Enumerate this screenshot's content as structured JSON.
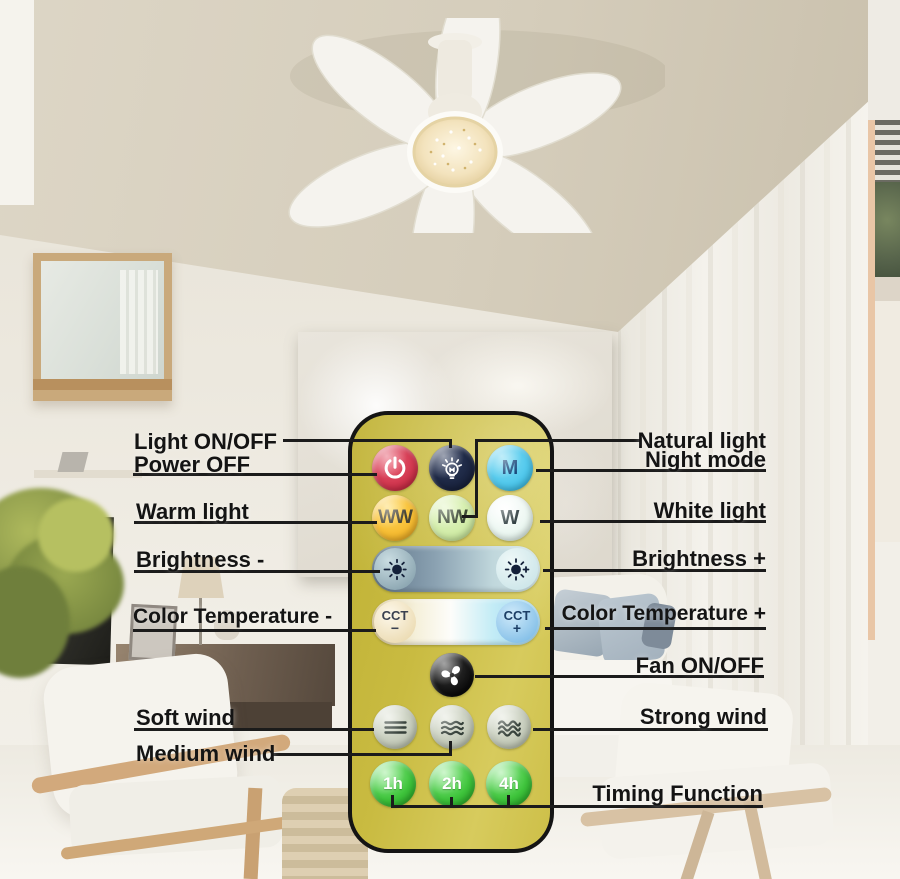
{
  "callouts": {
    "left": [
      {
        "id": "light-on-off",
        "text": "Light ON/OFF"
      },
      {
        "id": "power-off",
        "text": "Power OFF"
      },
      {
        "id": "warm-light",
        "text": "Warm light"
      },
      {
        "id": "brightness-minus",
        "text": "Brightness -"
      },
      {
        "id": "color-temperature-minus",
        "text": "Color Temperature -"
      },
      {
        "id": "soft-wind",
        "text": "Soft wind"
      },
      {
        "id": "medium-wind",
        "text": "Medium wind"
      }
    ],
    "right": [
      {
        "id": "natural-light",
        "text": "Natural light"
      },
      {
        "id": "night-mode",
        "text": "Night mode"
      },
      {
        "id": "white-light",
        "text": "White light"
      },
      {
        "id": "brightness-plus",
        "text": "Brightness +"
      },
      {
        "id": "color-temperature-plus",
        "text": "Color Temperature +"
      },
      {
        "id": "fan-on-off",
        "text": "Fan ON/OFF"
      },
      {
        "id": "strong-wind",
        "text": "Strong wind"
      },
      {
        "id": "timing-function",
        "text": "Timing Function"
      }
    ]
  },
  "remote": {
    "buttons": {
      "power": {
        "icon": "power-icon"
      },
      "light": {
        "icon": "bulb-icon"
      },
      "mode": {
        "label": "M"
      },
      "warm_white": {
        "label": "WW"
      },
      "natural_white": {
        "label": "NW"
      },
      "white": {
        "label": "W"
      },
      "brightness_down": {
        "icon": "sun-dim-icon"
      },
      "brightness_up": {
        "icon": "sun-bright-icon"
      },
      "cct_minus": {
        "label": "CCT",
        "sign": "−"
      },
      "cct_plus": {
        "label": "CCT",
        "sign": "+"
      },
      "fan_power": {
        "icon": "fan-icon"
      },
      "wind_soft": {
        "icon": "wind-soft-icon"
      },
      "wind_medium": {
        "icon": "wind-medium-icon"
      },
      "wind_strong": {
        "icon": "wind-strong-icon"
      },
      "timer_1h": {
        "label": "1h"
      },
      "timer_2h": {
        "label": "2h"
      },
      "timer_4h": {
        "label": "4h"
      }
    },
    "colors": {
      "body": "#c9bb41",
      "power_button": "#cc2e47",
      "light_button": "#17203a",
      "mode_button": "#45c3ea",
      "warm_white_button": "#f5b92e",
      "natural_white_button": "#cdeaa2",
      "white_button": "#e7f5ee",
      "cct_plus_button": "#85c0e8",
      "timer_button": "#3fc43c"
    }
  }
}
